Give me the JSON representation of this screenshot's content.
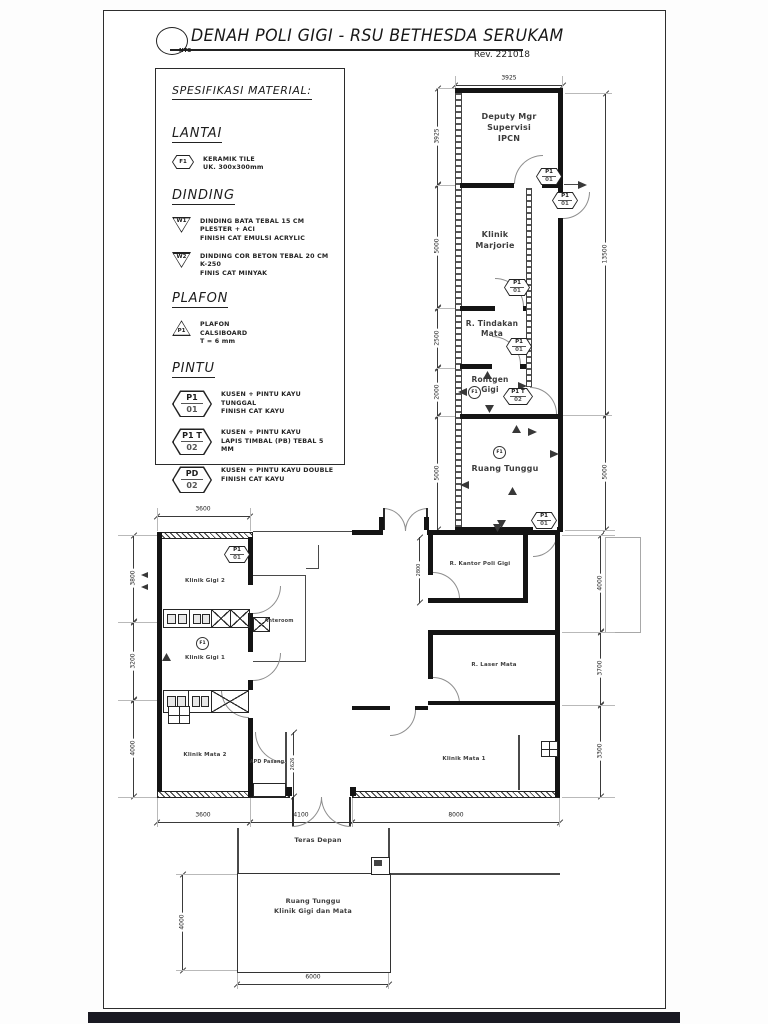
{
  "title": {
    "text": "DENAH POLI GIGI - RSU BETHESDA SERUKAM",
    "scale": "NTS",
    "revision": "Rev. 221018"
  },
  "spec": {
    "heading": "SPESIFIKASI MATERIAL:",
    "lantai": {
      "heading": "LANTAI",
      "tag": "F1",
      "lines": [
        "KERAMIK TILE",
        "UK. 300x300mm"
      ]
    },
    "dinding": {
      "heading": "DINDING",
      "items": [
        {
          "tag": "W1",
          "lines": [
            "DINDING BATA TEBAL 15 CM",
            "PLESTER + ACI",
            "FINISH CAT EMULSI ACRYLIC"
          ]
        },
        {
          "tag": "W2",
          "lines": [
            "DINDING COR BETON TEBAL 20 CM",
            "K-250",
            "FINIS CAT MINYAK"
          ]
        }
      ]
    },
    "plafon": {
      "heading": "PLAFON",
      "items": [
        {
          "tag": "P1",
          "lines": [
            "PLAFON",
            "CALSIBOARD",
            "T = 6 mm"
          ]
        }
      ]
    },
    "pintu": {
      "heading": "PINTU",
      "items": [
        {
          "tag": "P1",
          "sub": "01",
          "lines": [
            "KUSEN + PINTU KAYU TUNGGAL",
            "FINISH CAT KAYU"
          ]
        },
        {
          "tag": "P1 T",
          "sub": "02",
          "lines": [
            "KUSEN + PINTU KAYU",
            "LAPIS TIMBAL (PB) TEBAL 5 MM"
          ]
        },
        {
          "tag": "PD",
          "sub": "02",
          "lines": [
            "KUSEN + PINTU KAYU DOUBLE",
            "FINISH CAT KAYU"
          ]
        }
      ]
    }
  },
  "plan": {
    "rooms": {
      "deputy": "Deputy Mgr\nSupervisi\nIPCN",
      "marjorie": "Klinik\nMarjorie",
      "tindakan": "R. Tindakan\nMata",
      "rontgen": "Rontgen\nGigi",
      "ruang_tunggu": "Ruang Tunggu",
      "klinik_gigi_2": "Klinik Gigi 2",
      "klinik_gigi_1": "Klinik Gigi 1",
      "anteroom": "Anteroom",
      "klinik_mata_2": "Klinik Mata 2",
      "apd": "APD Pasang",
      "kantor": "R. Kantor Poli Gigi",
      "laser": "R. Laser Mata",
      "klinik_mata_1": "Klinik Mata 1",
      "teras": "Teras Depan",
      "ruang_tunggu_bawah": "Ruang Tunggu\nKlinik Gigi dan Mata"
    },
    "tags": {
      "p1": "P1",
      "p1t": "P1 T",
      "pd": "PD",
      "n01": "01",
      "n02": "02",
      "f1": "F1"
    },
    "dims": {
      "wing_top": "3925",
      "wing_left": [
        "3925",
        "5000",
        "2500",
        "2000",
        "5000"
      ],
      "wing_right": [
        "13500",
        "5000"
      ],
      "lower_top": "3600",
      "lower_left": [
        "3800",
        "3200",
        "4000"
      ],
      "lower_right": [
        "4000",
        "3700",
        "3300"
      ],
      "lower_bottom": [
        "3600",
        "4100",
        "8000"
      ],
      "apd_height": "2626",
      "kantor_height": "2800",
      "block_left": "4000",
      "block_bottom": "6000"
    }
  }
}
